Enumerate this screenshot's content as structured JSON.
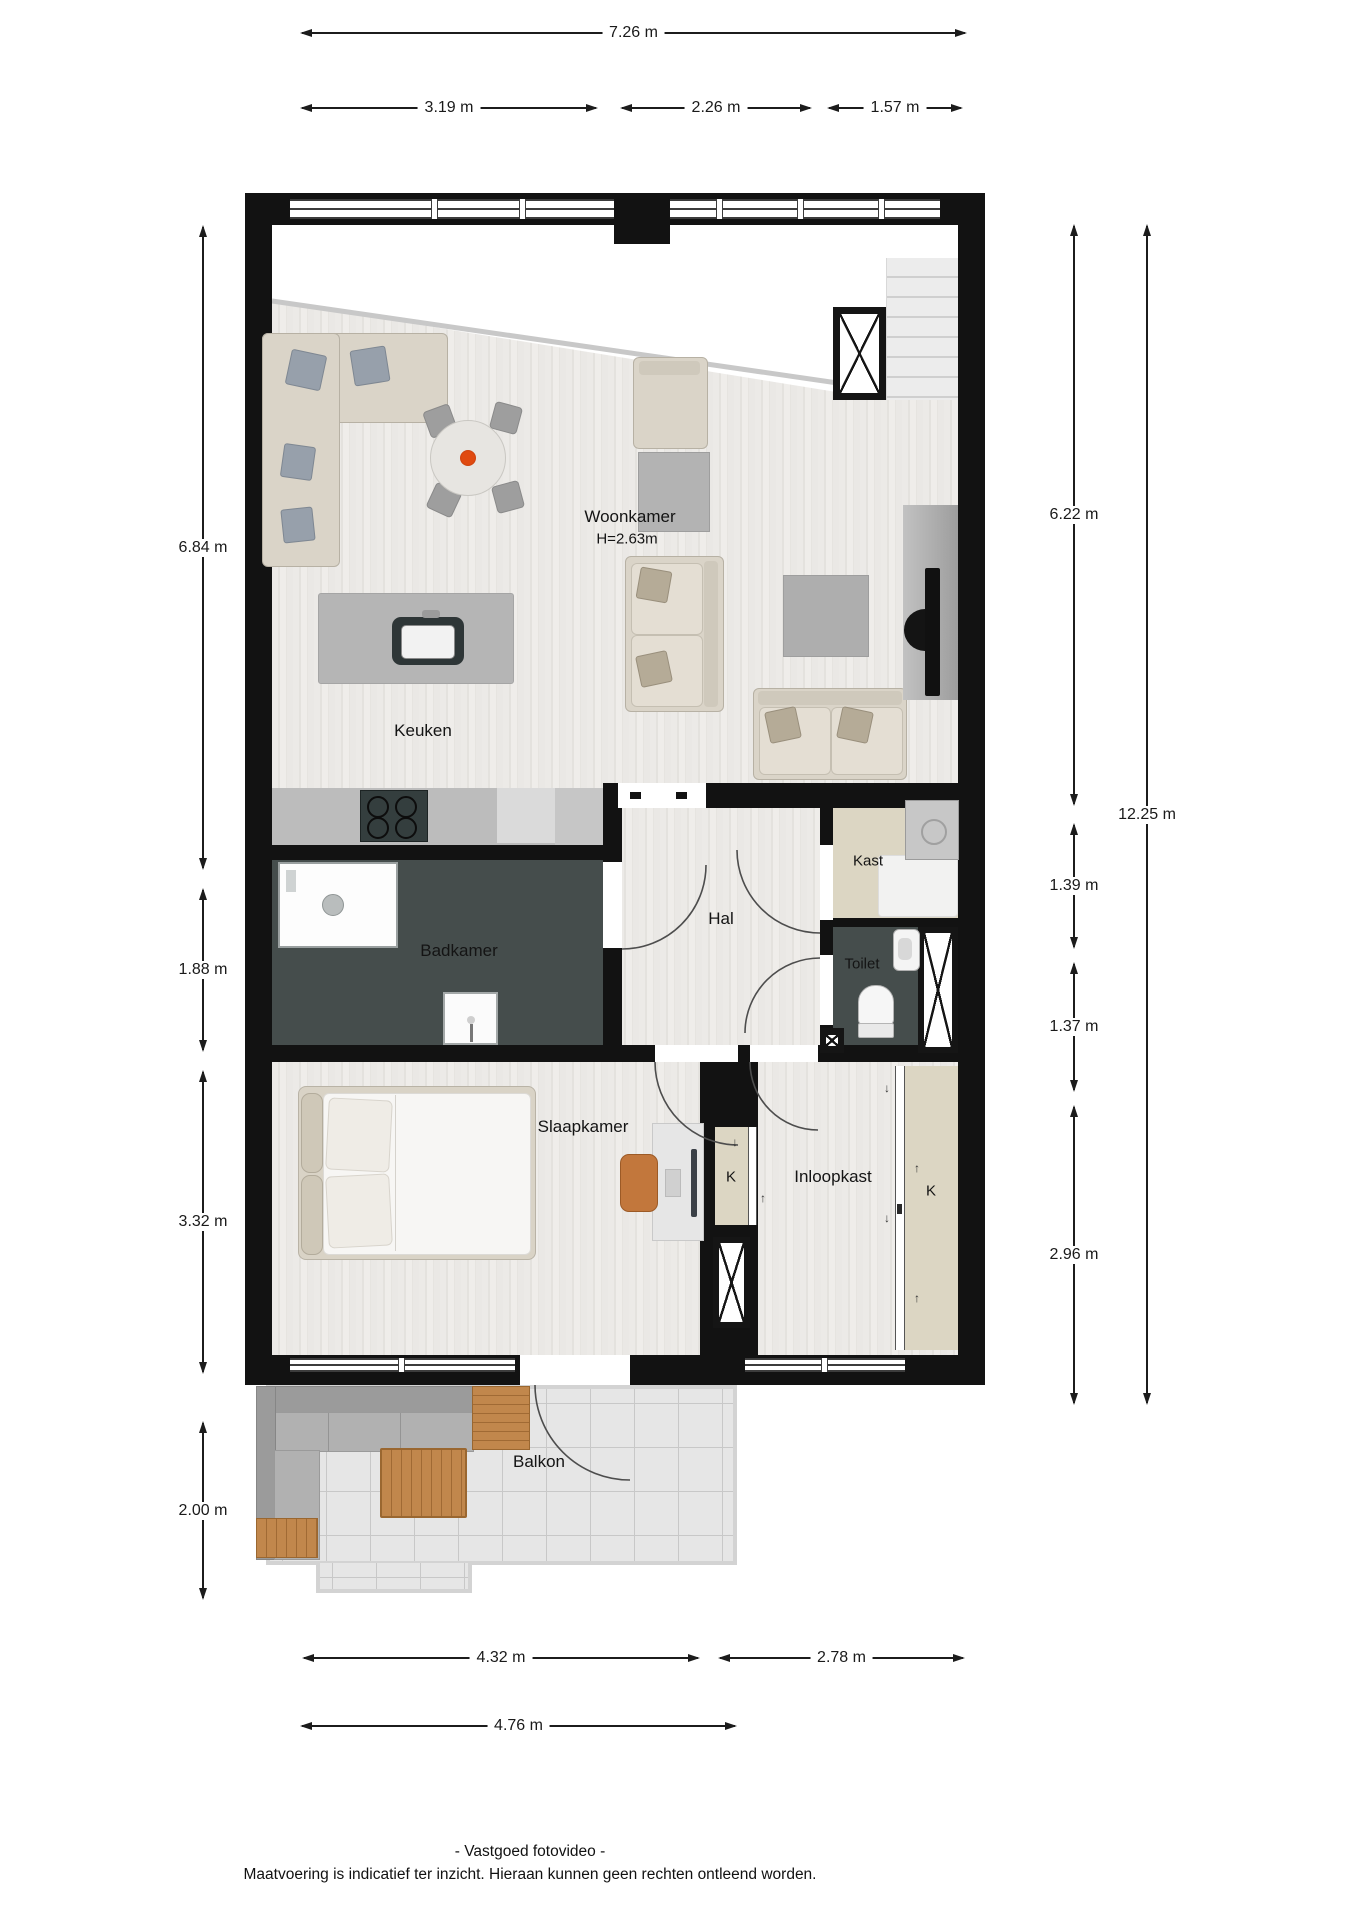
{
  "rooms": {
    "woonkamer": {
      "label": "Woonkamer",
      "height_note": "H=2.63m"
    },
    "keuken": {
      "label": "Keuken"
    },
    "badkamer": {
      "label": "Badkamer"
    },
    "hal": {
      "label": "Hal"
    },
    "kast": {
      "label": "Kast"
    },
    "toilet": {
      "label": "Toilet"
    },
    "slaapkamer": {
      "label": "Slaapkamer"
    },
    "inloopkast": {
      "label": "Inloopkast"
    },
    "closet_left": {
      "label": "K"
    },
    "closet_right": {
      "label": "K"
    },
    "balkon": {
      "label": "Balkon"
    }
  },
  "dimensions": {
    "top_total": "7.26 m",
    "top_segments": [
      "3.19 m",
      "2.26 m",
      "1.57 m"
    ],
    "left": [
      "6.84 m",
      "1.88 m",
      "3.32 m",
      "2.00 m"
    ],
    "right": [
      "6.22 m",
      "1.39 m",
      "1.37 m",
      "2.96 m"
    ],
    "right_total": "12.25 m",
    "bottom_segments": [
      "4.32 m",
      "2.78 m"
    ],
    "bottom_total": "4.76 m"
  },
  "icons": {
    "arrow_down": "↓",
    "arrow_up": "↑"
  },
  "footer": {
    "credit": "- Vastgoed fotovideo -",
    "disclaimer": "Maatvoering is indicatief ter inzicht. Hieraan kunnen geen rechten ontleend worden."
  },
  "colors": {
    "wall": "#121212",
    "floor_wood": "#eae8e5",
    "floor_wet_room": "#454d4c",
    "floor_closet": "#dcd6c3",
    "balcony_tile": "#e6e6e6",
    "wood_furniture": "#c1874c",
    "flower_accent": "#e04a10"
  }
}
